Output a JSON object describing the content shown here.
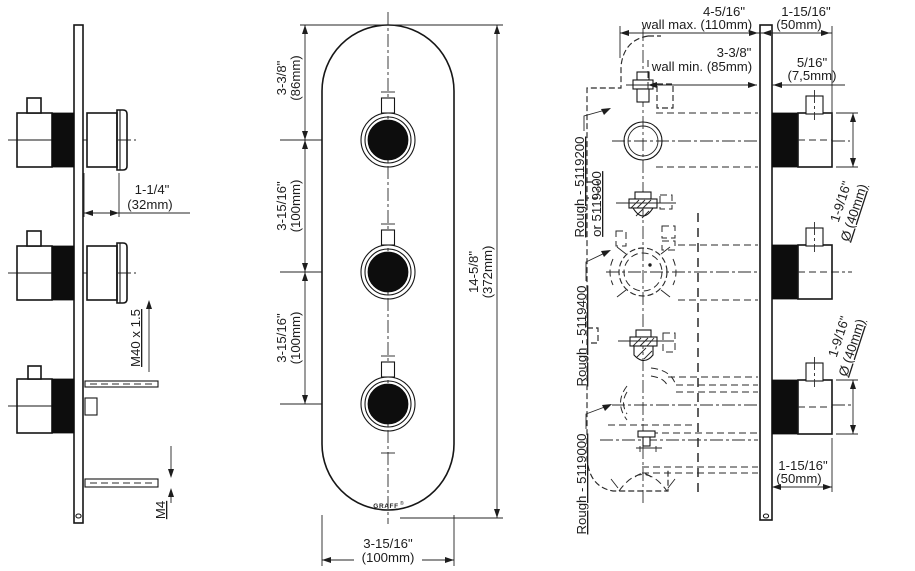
{
  "drawing": {
    "background": "#ffffff",
    "line_color": "#161616",
    "left_view": {
      "dim_handle_projection": {
        "inches": "1-1/4\"",
        "mm": "(32mm)"
      },
      "thread_label": "M40 x 1.5",
      "screw_label": "M4"
    },
    "front_view": {
      "dim_top_offset": {
        "inches": "3-3/8\"",
        "mm": "(86mm)"
      },
      "dim_spacing_upper": {
        "inches": "3-15/16\"",
        "mm": "(100mm)"
      },
      "dim_spacing_lower": {
        "inches": "3-15/16\"",
        "mm": "(100mm)"
      },
      "dim_total_height": {
        "inches": "14-5/8\"",
        "mm": "(372mm)"
      },
      "dim_width": {
        "inches": "3-15/16\"",
        "mm": "(100mm)"
      },
      "logo": "GRAFF",
      "logo_mark": "®"
    },
    "rough_view": {
      "dim_wall_max": {
        "inches": "4-5/16\"",
        "label": "wall max. (110mm)"
      },
      "dim_trim_depth": {
        "inches": "1-15/16\"",
        "mm": "(50mm)"
      },
      "dim_wall_min": {
        "inches": "3-3/8\"",
        "label": "wall min. (85mm)"
      },
      "dim_plate_gap": {
        "inches": "5/16\"",
        "mm": "(7,5mm)"
      },
      "labels": {
        "thermo_line1": "Rough - 5119200",
        "thermo_line2": "or 5119300",
        "mid": "Rough - 5119400",
        "bottom": "Rough - 5119000"
      }
    },
    "side_view": {
      "dim_knob_dia_upper": {
        "inches": "1-9/16\"",
        "mm": "Ø (40mm)"
      },
      "dim_knob_dia_lower": {
        "inches": "1-9/16\"",
        "mm": "Ø (40mm)"
      },
      "dim_knob_depth": {
        "inches": "1-15/16\"",
        "mm": "(50mm)"
      }
    }
  }
}
